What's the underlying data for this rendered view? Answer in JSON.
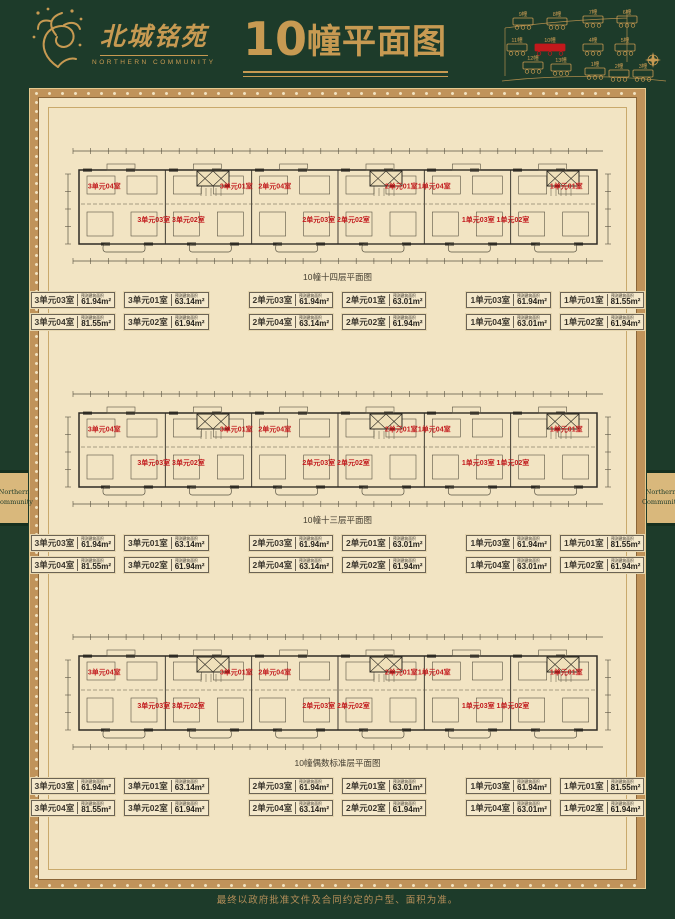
{
  "header": {
    "logo_name": "北城铭苑",
    "logo_subtitle": "NORTHERN COMMUNITY",
    "title_number": "10",
    "title_text": "幢平面图"
  },
  "sitemap": {
    "highlight_color": "#c2191c",
    "buildings": [
      {
        "label": "9幢",
        "x": 14,
        "y": 16,
        "highlight": false
      },
      {
        "label": "8幢",
        "x": 48,
        "y": 16,
        "highlight": false
      },
      {
        "label": "7幢",
        "x": 84,
        "y": 14,
        "highlight": false
      },
      {
        "label": "6幢",
        "x": 118,
        "y": 14,
        "highlight": false
      },
      {
        "label": "11幢",
        "x": 8,
        "y": 42,
        "highlight": false
      },
      {
        "label": "10幢",
        "x": 36,
        "y": 42,
        "highlight": true
      },
      {
        "label": "4幢",
        "x": 84,
        "y": 42,
        "highlight": false
      },
      {
        "label": "5幢",
        "x": 116,
        "y": 42,
        "highlight": false
      },
      {
        "label": "12幢",
        "x": 24,
        "y": 60,
        "highlight": false
      },
      {
        "label": "13幢",
        "x": 52,
        "y": 62,
        "highlight": false
      },
      {
        "label": "1幢",
        "x": 86,
        "y": 66,
        "highlight": false
      },
      {
        "label": "2幢",
        "x": 110,
        "y": 68,
        "highlight": false
      },
      {
        "label": "3幢",
        "x": 134,
        "y": 68,
        "highlight": false
      }
    ]
  },
  "side_tab": {
    "lines": [
      "Northern",
      "Community"
    ]
  },
  "legend_area_note": "预测建筑面积",
  "sections": [
    {
      "caption": "10幢十四层平面图",
      "plan_labels": [
        {
          "text": "3单元04室",
          "x": 0.075,
          "y": 0.36
        },
        {
          "text": "3单元03室",
          "x": 0.165,
          "y": 0.63
        },
        {
          "text": "3单元02室",
          "x": 0.228,
          "y": 0.63
        },
        {
          "text": "3单元01室",
          "x": 0.315,
          "y": 0.36
        },
        {
          "text": "2单元04室",
          "x": 0.385,
          "y": 0.36
        },
        {
          "text": "2单元03室",
          "x": 0.465,
          "y": 0.63
        },
        {
          "text": "2单元02室",
          "x": 0.528,
          "y": 0.63
        },
        {
          "text": "2单元01室",
          "x": 0.615,
          "y": 0.36
        },
        {
          "text": "1单元04室",
          "x": 0.675,
          "y": 0.36
        },
        {
          "text": "1单元03室",
          "x": 0.755,
          "y": 0.63
        },
        {
          "text": "1单元02室",
          "x": 0.818,
          "y": 0.63
        },
        {
          "text": "1单元01室",
          "x": 0.915,
          "y": 0.36
        }
      ],
      "legend_groups": [
        [
          {
            "unit": "3单元03室",
            "area": "61.94m²"
          },
          {
            "unit": "3单元01室",
            "area": "63.14m²"
          },
          {
            "unit": "3单元04室",
            "area": "81.55m²"
          },
          {
            "unit": "3单元02室",
            "area": "61.94m²"
          }
        ],
        [
          {
            "unit": "2单元03室",
            "area": "61.94m²"
          },
          {
            "unit": "2单元01室",
            "area": "63.01m²"
          },
          {
            "unit": "2单元04室",
            "area": "63.14m²"
          },
          {
            "unit": "2单元02室",
            "area": "61.94m²"
          }
        ],
        [
          {
            "unit": "1单元03室",
            "area": "61.94m²"
          },
          {
            "unit": "1单元01室",
            "area": "81.55m²"
          },
          {
            "unit": "1单元04室",
            "area": "63.01m²"
          },
          {
            "unit": "1单元02室",
            "area": "61.94m²"
          }
        ]
      ]
    },
    {
      "caption": "10幢十三层平面图",
      "plan_labels": [
        {
          "text": "3单元04室",
          "x": 0.075,
          "y": 0.36
        },
        {
          "text": "3单元03室",
          "x": 0.165,
          "y": 0.63
        },
        {
          "text": "3单元02室",
          "x": 0.228,
          "y": 0.63
        },
        {
          "text": "3单元01室",
          "x": 0.315,
          "y": 0.36
        },
        {
          "text": "2单元04室",
          "x": 0.385,
          "y": 0.36
        },
        {
          "text": "2单元03室",
          "x": 0.465,
          "y": 0.63
        },
        {
          "text": "2单元02室",
          "x": 0.528,
          "y": 0.63
        },
        {
          "text": "2单元01室",
          "x": 0.615,
          "y": 0.36
        },
        {
          "text": "1单元04室",
          "x": 0.675,
          "y": 0.36
        },
        {
          "text": "1单元03室",
          "x": 0.755,
          "y": 0.63
        },
        {
          "text": "1单元02室",
          "x": 0.818,
          "y": 0.63
        },
        {
          "text": "1单元01室",
          "x": 0.915,
          "y": 0.36
        }
      ],
      "legend_groups": [
        [
          {
            "unit": "3单元03室",
            "area": "61.94m²"
          },
          {
            "unit": "3单元01室",
            "area": "63.14m²"
          },
          {
            "unit": "3单元04室",
            "area": "81.55m²"
          },
          {
            "unit": "3单元02室",
            "area": "61.94m²"
          }
        ],
        [
          {
            "unit": "2单元03室",
            "area": "61.94m²"
          },
          {
            "unit": "2单元01室",
            "area": "63.01m²"
          },
          {
            "unit": "2单元04室",
            "area": "63.14m²"
          },
          {
            "unit": "2单元02室",
            "area": "61.94m²"
          }
        ],
        [
          {
            "unit": "1单元03室",
            "area": "61.94m²"
          },
          {
            "unit": "1单元01室",
            "area": "81.55m²"
          },
          {
            "unit": "1单元04室",
            "area": "63.01m²"
          },
          {
            "unit": "1单元02室",
            "area": "61.94m²"
          }
        ]
      ]
    },
    {
      "caption": "10幢偶数标准层平面图",
      "plan_labels": [
        {
          "text": "3单元04室",
          "x": 0.075,
          "y": 0.36
        },
        {
          "text": "3单元03室",
          "x": 0.165,
          "y": 0.63
        },
        {
          "text": "3单元02室",
          "x": 0.228,
          "y": 0.63
        },
        {
          "text": "3单元01室",
          "x": 0.315,
          "y": 0.36
        },
        {
          "text": "2单元04室",
          "x": 0.385,
          "y": 0.36
        },
        {
          "text": "2单元03室",
          "x": 0.465,
          "y": 0.63
        },
        {
          "text": "2单元02室",
          "x": 0.528,
          "y": 0.63
        },
        {
          "text": "2单元01室",
          "x": 0.615,
          "y": 0.36
        },
        {
          "text": "1单元04室",
          "x": 0.675,
          "y": 0.36
        },
        {
          "text": "1单元03室",
          "x": 0.755,
          "y": 0.63
        },
        {
          "text": "1单元02室",
          "x": 0.818,
          "y": 0.63
        },
        {
          "text": "1单元01室",
          "x": 0.915,
          "y": 0.36
        }
      ],
      "legend_groups": [
        [
          {
            "unit": "3单元03室",
            "area": "61.94m²"
          },
          {
            "unit": "3单元01室",
            "area": "63.14m²"
          },
          {
            "unit": "3单元04室",
            "area": "81.55m²"
          },
          {
            "unit": "3单元02室",
            "area": "61.94m²"
          }
        ],
        [
          {
            "unit": "2单元03室",
            "area": "61.94m²"
          },
          {
            "unit": "2单元01室",
            "area": "63.01m²"
          },
          {
            "unit": "2单元04室",
            "area": "63.14m²"
          },
          {
            "unit": "2单元02室",
            "area": "61.94m²"
          }
        ],
        [
          {
            "unit": "1单元03室",
            "area": "61.94m²"
          },
          {
            "unit": "1单元01室",
            "area": "81.55m²"
          },
          {
            "unit": "1单元04室",
            "area": "63.01m²"
          },
          {
            "unit": "1单元02室",
            "area": "61.94m²"
          }
        ]
      ]
    }
  ],
  "footer": {
    "disclaimer": "最终以政府批准文件及合同约定的户型、面积为准。"
  },
  "colors": {
    "background": "#1d3b2a",
    "gold": "#c79a52",
    "page": "#f2e4c3",
    "accent_red": "#c2191c"
  }
}
